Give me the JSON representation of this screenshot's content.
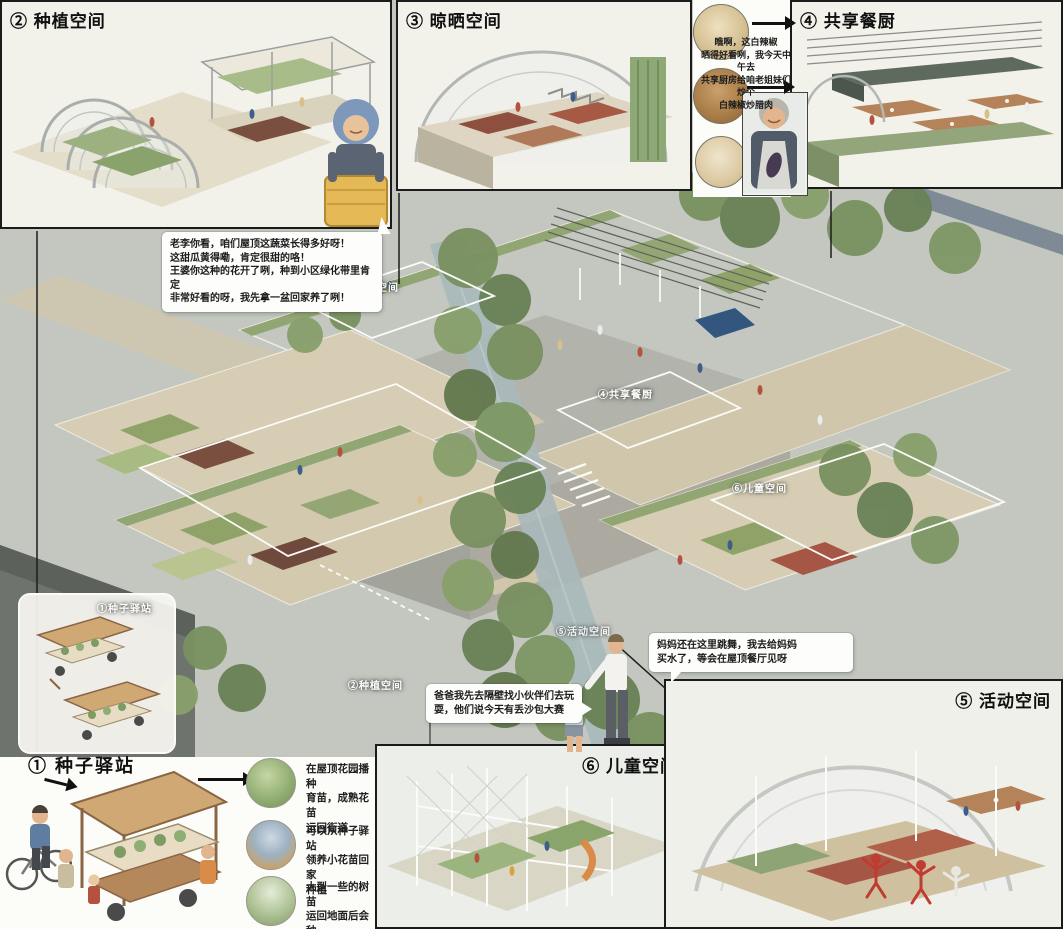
{
  "panels": {
    "planting": {
      "label": "② 种植空间"
    },
    "drying": {
      "label": "③ 晾晒空间"
    },
    "kitchen": {
      "label": "④ 共享餐厨"
    },
    "activity": {
      "label": "⑤ 活动空间"
    },
    "children": {
      "label": "⑥ 儿童空间"
    }
  },
  "seed_station": {
    "label": "① 种子驿站",
    "legend": [
      {
        "icon": "seedling-photo",
        "text": "在屋顶花园播种\n育苗，成熟花苗\n运回街道"
      },
      {
        "icon": "flower-adopt-photo",
        "text": "可以从种子驿站\n领养小花苗回家\n种植"
      },
      {
        "icon": "sapling-photo",
        "text": "大型一些的树苗\n运回地面后会种\n植在绿化带里"
      }
    ]
  },
  "axon_labels": {
    "seed": "①种子驿站",
    "planting": "②种植空间",
    "drying": "③晾晒空间",
    "kitchen": "④共享餐厨",
    "activity": "⑤活动空间",
    "children": "⑥儿童空间"
  },
  "speech_bubbles": {
    "veggie_chat": "老李你看，咱们屋顶这蔬菜长得多好呀！\n这甜瓜黄得嘞，肯定很甜的咯！\n王婆你这种的花开了咧，种到小区绿化带里肯定\n非常好看的呀，我先拿一盆回家养了咧！",
    "chili_chat": "瞧啊，这白辣椒\n晒得好看咧，我今天中午去\n共享厨房给咱老姐妹们炒个\n白辣椒炒腊肉",
    "dance_chat": "妈妈还在这里跳舞，我去给妈妈\n买水了，等会在屋顶餐厅见呀",
    "play_chat": "爸爸我先去隔壁找小伙伴们去玩\n耍，他们说今天有丢沙包大赛"
  },
  "food_icons": [
    "white-chili-photo",
    "dried-vegetable-photo",
    "cured-meat-photo"
  ],
  "colors": {
    "deck": "#d8cfb6",
    "green_roof": "#92a673",
    "tree": "#7a9161",
    "dancer_red": "#c13b30",
    "basket_yellow": "#e3b855",
    "canal": "#a9b8ba"
  }
}
